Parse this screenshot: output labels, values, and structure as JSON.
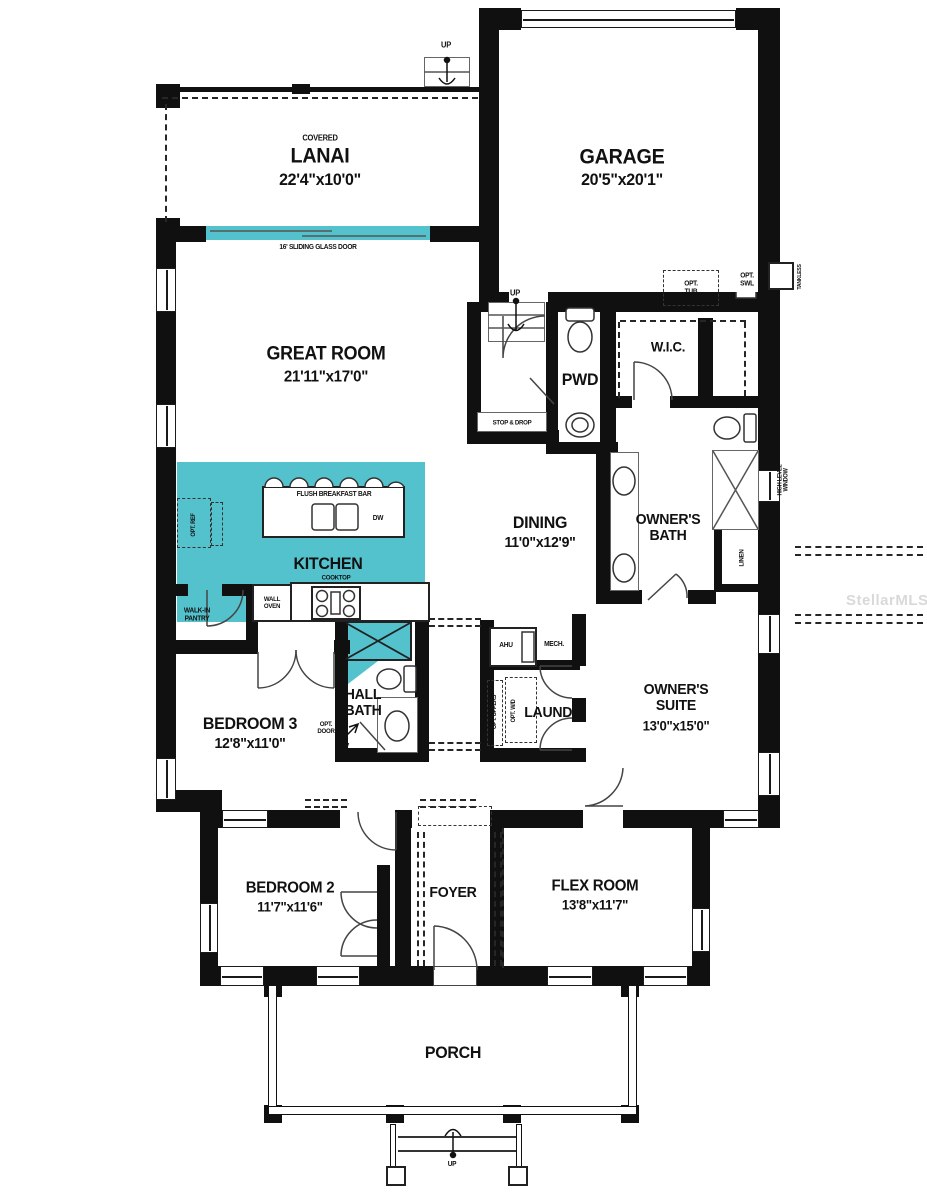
{
  "title": "Single-story floor plan",
  "watermark": "StellarMLS",
  "colors": {
    "highlight": "#53c2cd",
    "wall": "#101010",
    "watermark_text": "#d9d9d9"
  },
  "rooms": {
    "lanai": {
      "prefix": "COVERED",
      "name": "LANAI",
      "dims": "22'4\"x10'0\""
    },
    "garage": {
      "name": "GARAGE",
      "dims": "20'5\"x20'1\""
    },
    "great_room": {
      "name": "GREAT ROOM",
      "dims": "21'11\"x17'0\""
    },
    "pwd": {
      "name": "PWD"
    },
    "wic": {
      "name": "W.I.C."
    },
    "dining": {
      "name": "DINING",
      "dims": "11'0\"x12'9\""
    },
    "owners_bath": {
      "name": "OWNER'S BATH"
    },
    "kitchen": {
      "name": "KITCHEN"
    },
    "hall_bath": {
      "name": "HALL BATH"
    },
    "bedroom3": {
      "name": "BEDROOM 3",
      "dims": "12'8\"x11'0\""
    },
    "laundry": {
      "name": "LAUND."
    },
    "owners_suite": {
      "name": "OWNER'S SUITE",
      "dims": "13'0\"x15'0\""
    },
    "bedroom2": {
      "name": "BEDROOM 2",
      "dims": "11'7\"x11'6\""
    },
    "foyer": {
      "name": "FOYER"
    },
    "flex": {
      "name": "FLEX ROOM",
      "dims": "13'8\"x11'7\""
    },
    "porch": {
      "name": "PORCH"
    }
  },
  "annotations": {
    "sliding_door": "16' SLIDING GLASS DOOR",
    "stop_drop": "STOP & DROP",
    "linen": "LINEN",
    "opt_tub": "OPT. TUB",
    "opt_swl": "OPT. SWL",
    "tankless": "TANKLESS",
    "high_level_window": "HIGH LEVEL WINDOW",
    "flush_bar": "FLUSH BREAKFAST BAR",
    "dw": "DW",
    "cooktop": "COOKTOP",
    "wall_oven": "WALL OVEN",
    "opt_ref": "OPT. REF",
    "walk_in_pantry": "WALK-IN PANTRY",
    "opt_door": "OPT. DOOR",
    "ahu": "AHU",
    "mech": "MECH.",
    "opt_uppers": "OPT. UPPERS",
    "opt_wd": "OPT. W/D",
    "up": "UP"
  }
}
